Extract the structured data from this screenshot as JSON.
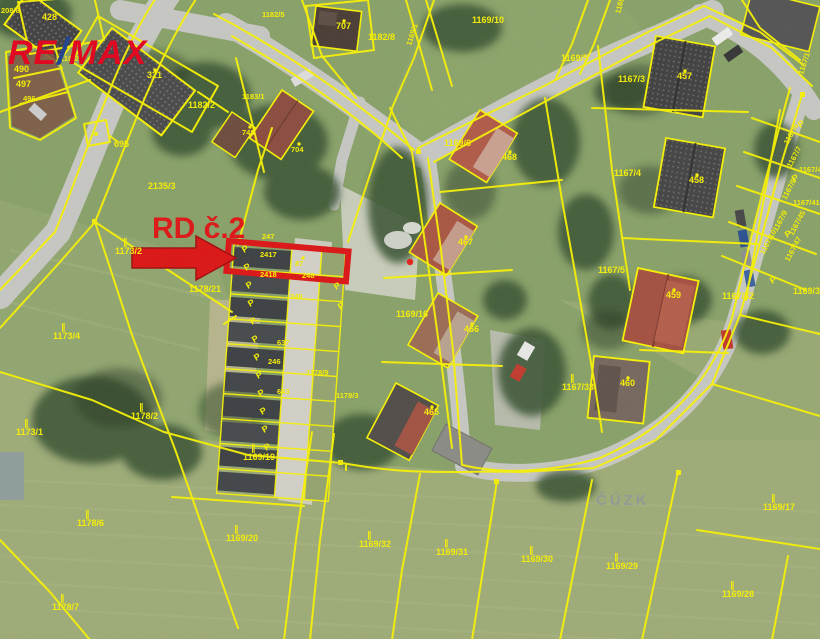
{
  "map": {
    "logo": {
      "part1": "RE",
      "slash": "/",
      "part2": "MAX"
    },
    "annotation": {
      "label": "RD č.2"
    },
    "watermark": "ČÚZK",
    "colors": {
      "cadastral_line": "#f8f200",
      "highlight_red": "#dc1212",
      "logo_red": "#e2001a",
      "logo_blue": "#1e3f8f",
      "watermark_gray": "#8e959b"
    },
    "parcel_labels": [
      {
        "text": "208/8",
        "x": 1,
        "y": 13,
        "small": true
      },
      {
        "text": "428",
        "x": 42,
        "y": 20
      },
      {
        "text": "2110/2",
        "x": 56,
        "y": 61,
        "small": true
      },
      {
        "text": "490",
        "x": 14,
        "y": 72
      },
      {
        "text": "497",
        "x": 16,
        "y": 87
      },
      {
        "text": "496",
        "x": 23,
        "y": 101,
        "small": true
      },
      {
        "text": "321",
        "x": 147,
        "y": 78,
        "dot": true
      },
      {
        "text": "1182/5",
        "x": 262,
        "y": 17,
        "small": true
      },
      {
        "text": "707",
        "x": 336,
        "y": 29,
        "dot": true
      },
      {
        "text": "1182/8",
        "x": 368,
        "y": 40
      },
      {
        "text": "1169/1",
        "x": 411,
        "y": 46,
        "rot": -72,
        "small": true
      },
      {
        "text": "1182/2",
        "x": 188,
        "y": 108
      },
      {
        "text": "1183/1",
        "x": 242,
        "y": 99,
        "small": true
      },
      {
        "text": "748",
        "x": 242,
        "y": 135,
        "dot": true,
        "small": true
      },
      {
        "text": "704",
        "x": 291,
        "y": 152,
        "dot": true,
        "small": true
      },
      {
        "text": "695",
        "x": 114,
        "y": 147
      },
      {
        "text": "1169/10",
        "x": 472,
        "y": 23
      },
      {
        "text": "1169/9",
        "x": 620,
        "y": 14,
        "rot": -75,
        "small": true
      },
      {
        "text": "1169/5",
        "x": 561,
        "y": 61
      },
      {
        "text": "1167/3",
        "x": 618,
        "y": 82
      },
      {
        "text": "457",
        "x": 677,
        "y": 79,
        "dot": true
      },
      {
        "text": "1167/1",
        "x": 803,
        "y": 75,
        "rot": -72,
        "small": true
      },
      {
        "text": "1167/4",
        "x": 614,
        "y": 176
      },
      {
        "text": "458",
        "x": 689,
        "y": 183,
        "dot": true
      },
      {
        "text": "1167/6",
        "x": 788,
        "y": 145,
        "rot": -62,
        "small": true
      },
      {
        "text": "1167/7",
        "x": 791,
        "y": 168,
        "rot": -62,
        "small": true
      },
      {
        "text": "1167/44",
        "x": 799,
        "y": 172,
        "small": true
      },
      {
        "text": "1167/8",
        "x": 786,
        "y": 200,
        "rot": -62,
        "small": true
      },
      {
        "text": "1167/41",
        "x": 793,
        "y": 205,
        "small": true
      },
      {
        "text": "1167/9",
        "x": 777,
        "y": 232,
        "rot": -62,
        "small": true
      },
      {
        "text": "1167/45",
        "x": 793,
        "y": 236,
        "rot": -62,
        "small": true
      },
      {
        "text": "1167/10",
        "x": 764,
        "y": 255,
        "rot": -62,
        "small": true
      },
      {
        "text": "1167/47",
        "x": 789,
        "y": 262,
        "rot": -62,
        "small": true
      },
      {
        "text": "1167/5",
        "x": 598,
        "y": 273
      },
      {
        "text": "459",
        "x": 666,
        "y": 298,
        "dot": true
      },
      {
        "text": "1167/32",
        "x": 722,
        "y": 299
      },
      {
        "text": "1169/34",
        "x": 793,
        "y": 294
      },
      {
        "text": "1167/33",
        "x": 562,
        "y": 390,
        "sym": true
      },
      {
        "text": "460",
        "x": 620,
        "y": 386,
        "dot": true
      },
      {
        "text": "1169/6",
        "x": 444,
        "y": 146
      },
      {
        "text": "468",
        "x": 502,
        "y": 160,
        "dot": true
      },
      {
        "text": "467",
        "x": 458,
        "y": 245,
        "dot": true
      },
      {
        "text": "466",
        "x": 464,
        "y": 332,
        "dot": true
      },
      {
        "text": "465",
        "x": 424,
        "y": 415,
        "dot": true
      },
      {
        "text": "1169/16",
        "x": 396,
        "y": 317
      },
      {
        "text": "2135/3",
        "x": 148,
        "y": 189
      },
      {
        "text": "1178/21",
        "x": 189,
        "y": 292
      },
      {
        "text": "1173/2",
        "x": 115,
        "y": 254,
        "sym": true
      },
      {
        "text": "1173/4",
        "x": 53,
        "y": 339,
        "sym": true
      },
      {
        "text": "1173/1",
        "x": 16,
        "y": 435,
        "sym": true
      },
      {
        "text": "1178/2",
        "x": 131,
        "y": 419,
        "sym": true
      },
      {
        "text": "1169/19",
        "x": 243,
        "y": 460,
        "sym": true
      },
      {
        "text": "1169/20",
        "x": 226,
        "y": 541,
        "sym": true
      },
      {
        "text": "1169/32",
        "x": 359,
        "y": 547,
        "sym": true
      },
      {
        "text": "1169/31",
        "x": 436,
        "y": 555,
        "sym": true
      },
      {
        "text": "1169/30",
        "x": 521,
        "y": 562,
        "sym": true
      },
      {
        "text": "1169/29",
        "x": 606,
        "y": 569,
        "sym": true
      },
      {
        "text": "1169/17",
        "x": 763,
        "y": 510,
        "sym": true
      },
      {
        "text": "1169/28",
        "x": 722,
        "y": 597,
        "sym": true
      },
      {
        "text": "1178/6",
        "x": 77,
        "y": 526,
        "sym": true
      },
      {
        "text": "1178/7",
        "x": 52,
        "y": 610,
        "sym": true
      },
      {
        "text": "247",
        "x": 262,
        "y": 239,
        "small": true
      },
      {
        "text": "2417",
        "x": 260,
        "y": 257,
        "small": true
      },
      {
        "text": "87",
        "x": 295,
        "y": 266,
        "dot": true,
        "small": true
      },
      {
        "text": "2418",
        "x": 260,
        "y": 277,
        "small": true
      },
      {
        "text": "248",
        "x": 302,
        "y": 278,
        "small": true
      },
      {
        "text": "249",
        "x": 290,
        "y": 299,
        "small": true
      },
      {
        "text": "637",
        "x": 277,
        "y": 345,
        "small": true
      },
      {
        "text": "246",
        "x": 268,
        "y": 364,
        "small": true
      },
      {
        "text": "643",
        "x": 277,
        "y": 394,
        "small": true
      },
      {
        "text": "1178/9",
        "x": 306,
        "y": 375,
        "small": true
      },
      {
        "text": "1178/3",
        "x": 336,
        "y": 398,
        "small": true
      }
    ],
    "p_symbols": [
      {
        "x": 244,
        "y": 253
      },
      {
        "x": 246,
        "y": 271
      },
      {
        "x": 248,
        "y": 289
      },
      {
        "x": 250,
        "y": 307
      },
      {
        "x": 252,
        "y": 325
      },
      {
        "x": 254,
        "y": 343
      },
      {
        "x": 256,
        "y": 361
      },
      {
        "x": 258,
        "y": 379
      },
      {
        "x": 260,
        "y": 397
      },
      {
        "x": 262,
        "y": 415
      },
      {
        "x": 264,
        "y": 433
      },
      {
        "x": 266,
        "y": 451
      },
      {
        "x": 336,
        "y": 290
      },
      {
        "x": 340,
        "y": 310
      },
      {
        "x": 800,
        "y": 128
      },
      {
        "x": 794,
        "y": 182
      },
      {
        "x": 787,
        "y": 238
      },
      {
        "x": 772,
        "y": 284
      }
    ]
  }
}
